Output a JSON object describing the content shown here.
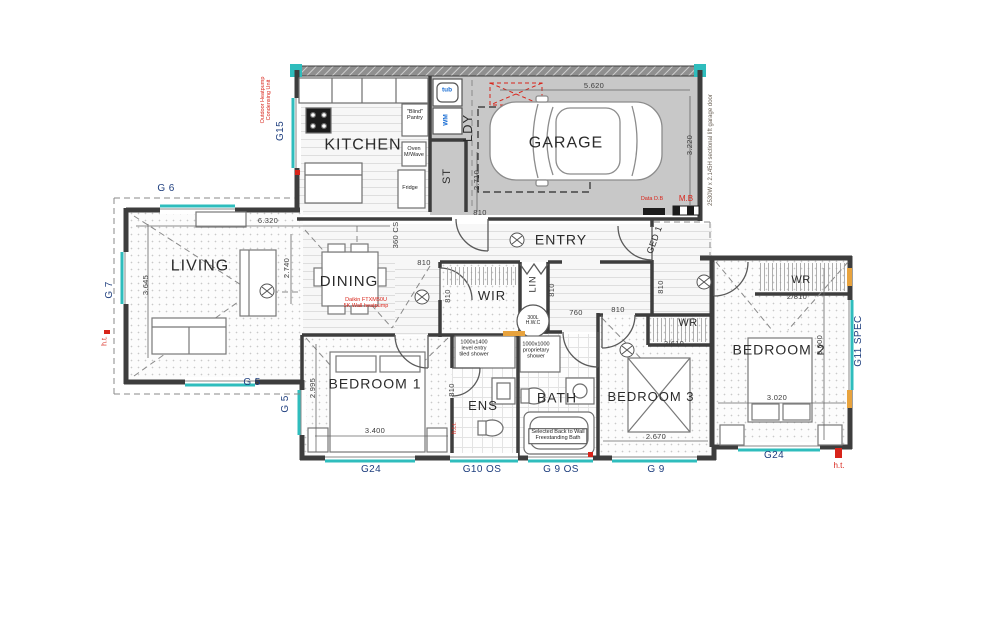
{
  "rooms": {
    "kitchen": "KITCHEN",
    "garage": "GARAGE",
    "laundry": "LDY",
    "store": "ST",
    "entry": "ENTRY",
    "living": "LIVING",
    "dining": "DINING",
    "wir": "WIR",
    "linen": "LIN",
    "bedroom1": "BEDROOM 1",
    "ensuite": "ENS",
    "bath": "BATH",
    "bedroom3": "BEDROOM 3",
    "bedroom2": "BEDROOM 2",
    "wr_a": "WR",
    "wr_b": "WR"
  },
  "fixtures": {
    "tub": "tub",
    "wm": "WM",
    "pantry1": "\"Blind\"",
    "pantry2": "Pantry",
    "oven1": "Oven",
    "oven2": "M/Wave",
    "fridge": "Fridge",
    "hwc1": "300L",
    "hwc2": "H.W.C"
  },
  "dims": {
    "garage_w": "5.620",
    "garage_d": "3.220",
    "ldy": "2.710",
    "living_w": "6.320",
    "dining_d": "2.740",
    "living_d": "3.645",
    "cs": "360 CS",
    "d810": "810",
    "d760": "760",
    "bed1_d": "2.995",
    "bed1_w": "3.400",
    "bed3_w": "2.670",
    "bed2_d": "3.000",
    "bed2_w": "3.020",
    "wr3": "2/610",
    "wr2": "2/810"
  },
  "openings": {
    "g15": "G15",
    "g6": "G 6",
    "g7": "G 7",
    "g5": "G 5",
    "g24": "G24",
    "g10os": "G10 OS",
    "g9os": "G 9 OS",
    "g9": "G 9",
    "g11": "G11 SPEC",
    "ged1": "GED 1"
  },
  "notes": {
    "outdoor1": "Outdoor Heatpump",
    "outdoor2": "Condensing Unit",
    "daikin1": "Daikin FTXM50U",
    "daikin2": "5K Wall heatpump",
    "data_db": "Data D.B",
    "mb": "M.B",
    "ht": "h.t.",
    "htr": "h.t.r.",
    "garage_door": "2530W x 2.145H sectional lift garage door",
    "ens_shower": [
      "1000x1400",
      "level entry",
      "tiled shower"
    ],
    "bath_shower": [
      "1000x1000",
      "proprietary",
      "shower"
    ],
    "bath_note": [
      "Selected Back to Wall",
      "Freestanding Bath"
    ]
  },
  "colors": {
    "wall": "#3d3d3d",
    "teal": "#2fbdbd",
    "red": "#d8241a",
    "navy": "#1e3e7e",
    "blue": "#1c6fd4",
    "garage_fill": "#c8c8c8"
  }
}
